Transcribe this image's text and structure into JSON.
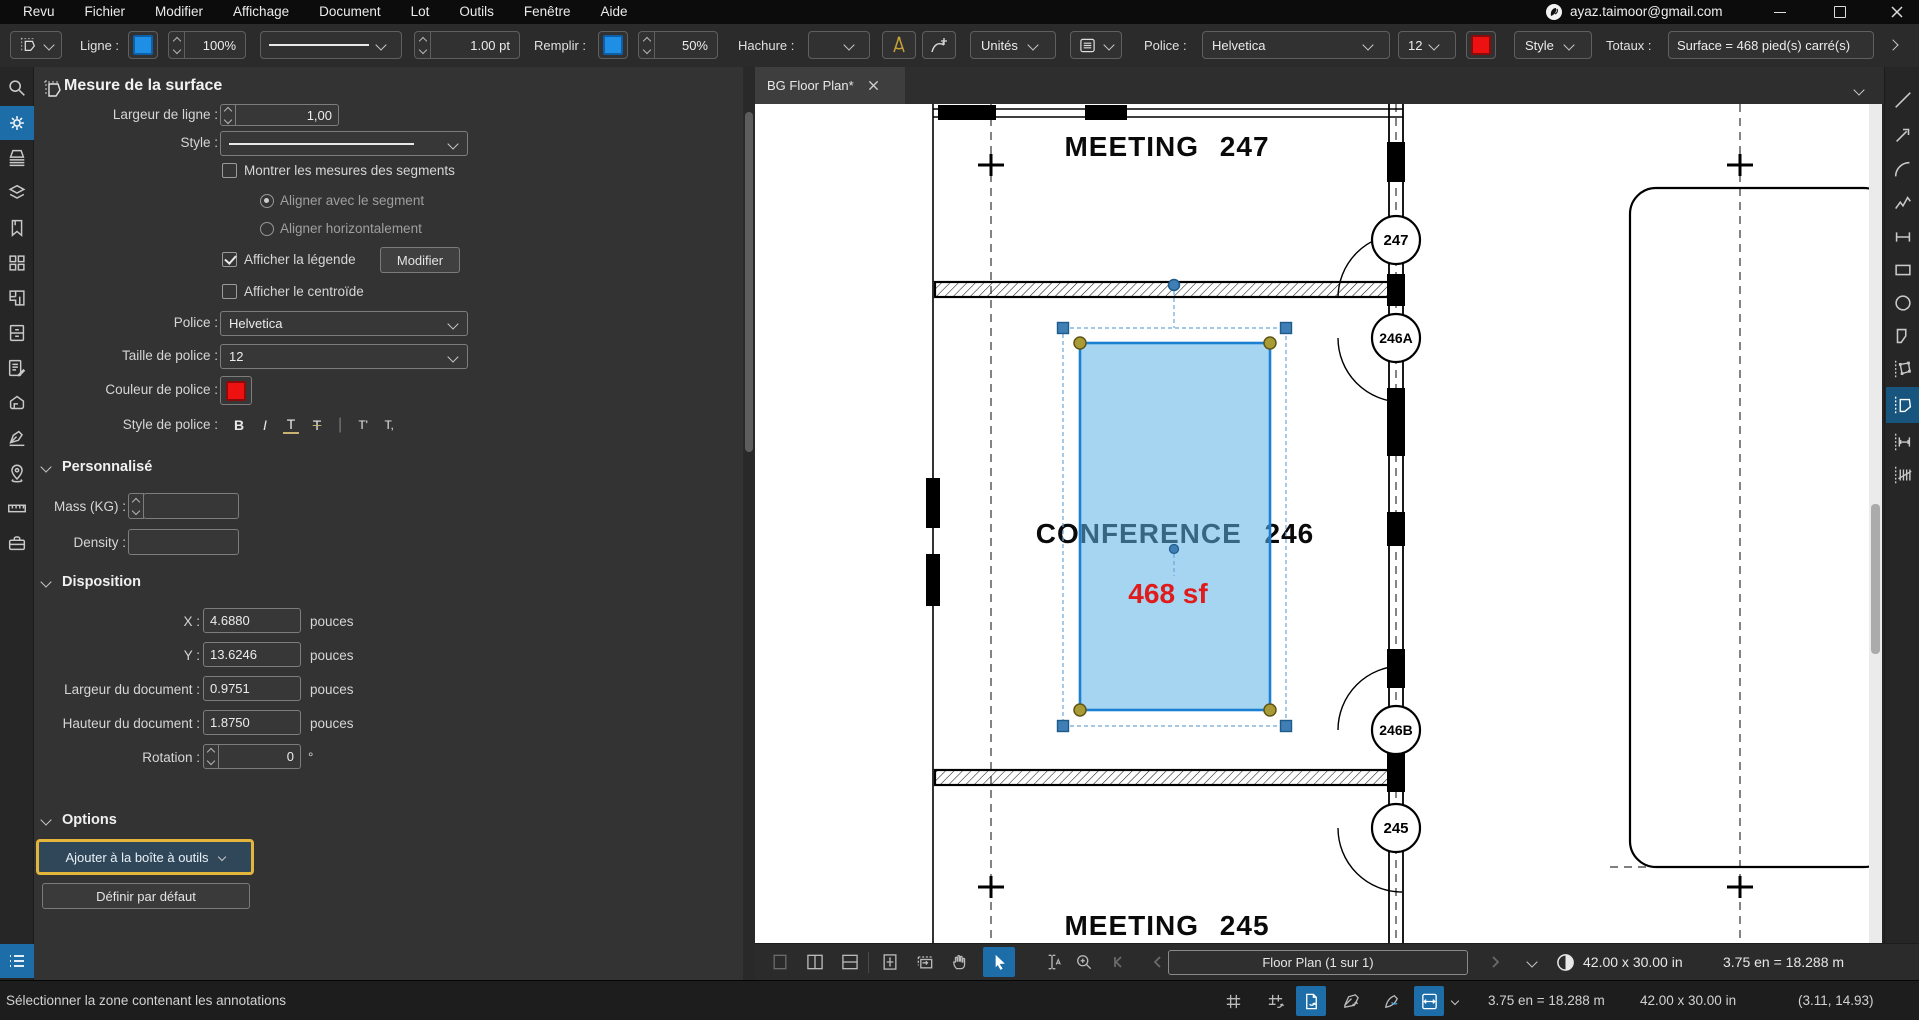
{
  "window": {
    "menus": [
      "Revu",
      "Fichier",
      "Modifier",
      "Affichage",
      "Document",
      "Lot",
      "Outils",
      "Fenêtre",
      "Aide"
    ],
    "account": "ayaz.taimoor@gmail.com"
  },
  "toolbar": {
    "ligne": "Ligne :",
    "ligne_opacity": "100%",
    "stroke_width": "1.00 pt",
    "remplir": "Remplir :",
    "fill_opacity": "50%",
    "hachure": "Hachure :",
    "unites": "Unités",
    "police": "Police :",
    "police_value": "Helvetica",
    "taille_value": "12",
    "style": "Style",
    "totaux": "Totaux :",
    "totaux_value": "Surface = 468 pied(s) carré(s)"
  },
  "panel": {
    "title": "Mesure de la surface",
    "largeur_ligne_label": "Largeur de ligne :",
    "largeur_ligne_value": "1,00",
    "style_label": "Style :",
    "montrer_segments": "Montrer les mesures des segments",
    "aligner_segment": "Aligner avec le segment",
    "aligner_horizontal": "Aligner horizontalement",
    "afficher_legende": "Afficher la légende",
    "modifier": "Modifier",
    "afficher_centroide": "Afficher le centroïde",
    "police_label": "Police :",
    "police_value": "Helvetica",
    "taille_label": "Taille de police :",
    "taille_value": "12",
    "couleur_label": "Couleur de police :",
    "style_police_label": "Style de police :",
    "font_styles": [
      "B",
      "I",
      "T",
      "T",
      "T'",
      "T,"
    ],
    "personnalise": "Personnalisé",
    "mass_label": "Mass (KG) :",
    "mass_value": "",
    "density_label": "Density :",
    "density_value": "",
    "disposition": "Disposition",
    "x_label": "X :",
    "x_value": "4.6880",
    "y_label": "Y :",
    "y_value": "13.6246",
    "largeur_doc_label": "Largeur du document :",
    "largeur_doc_value": "0.9751",
    "hauteur_doc_label": "Hauteur du document :",
    "hauteur_doc_value": "1.8750",
    "rotation_label": "Rotation :",
    "rotation_value": "0",
    "degree": "°",
    "unit": "pouces",
    "options": "Options",
    "ajouter_boite": "Ajouter à la boîte à outils",
    "definir_defaut": "Définir par défaut"
  },
  "document": {
    "tab": "BG Floor Plan*",
    "room_top": "MEETING 247",
    "room_conf": "CONFERENCE 246",
    "area_label": "468 sf",
    "room_bottom": "MEETING 245",
    "door_tags": [
      "247",
      "246A",
      "246B",
      "245"
    ]
  },
  "nav": {
    "page": "Floor Plan (1 sur 1)",
    "size": "42.00 x 30.00 in",
    "scale": "3.75 en = 18.288 m"
  },
  "status": {
    "message": "Sélectionner la zone contenant les annotations",
    "scale": "3.75 en = 18.288 m",
    "size": "42.00 x 30.00 in",
    "coords": "(3.11, 14.93)"
  },
  "icons": {
    "left_rail": [
      "search",
      "properties-gear",
      "thumbnails",
      "layers",
      "bookmarks",
      "spaces",
      "flags",
      "file-access",
      "markup-list",
      "3d-model",
      "calibrate",
      "places",
      "measure",
      "toolbox"
    ],
    "right_rail": [
      "line",
      "arrow",
      "arc",
      "polyline",
      "dimension",
      "rectangle",
      "ellipse",
      "polygon",
      "perimeter",
      "area-measure",
      "length-measure",
      "count"
    ]
  },
  "colors": {
    "accent_blue": "#1c6da8",
    "line_color": "#1f8fe6",
    "font_color": "#ee2222",
    "highlight_yellow": "#e3b53a",
    "selection_fill": "#8ccbf0",
    "selection_stroke": "#1b80d2"
  }
}
